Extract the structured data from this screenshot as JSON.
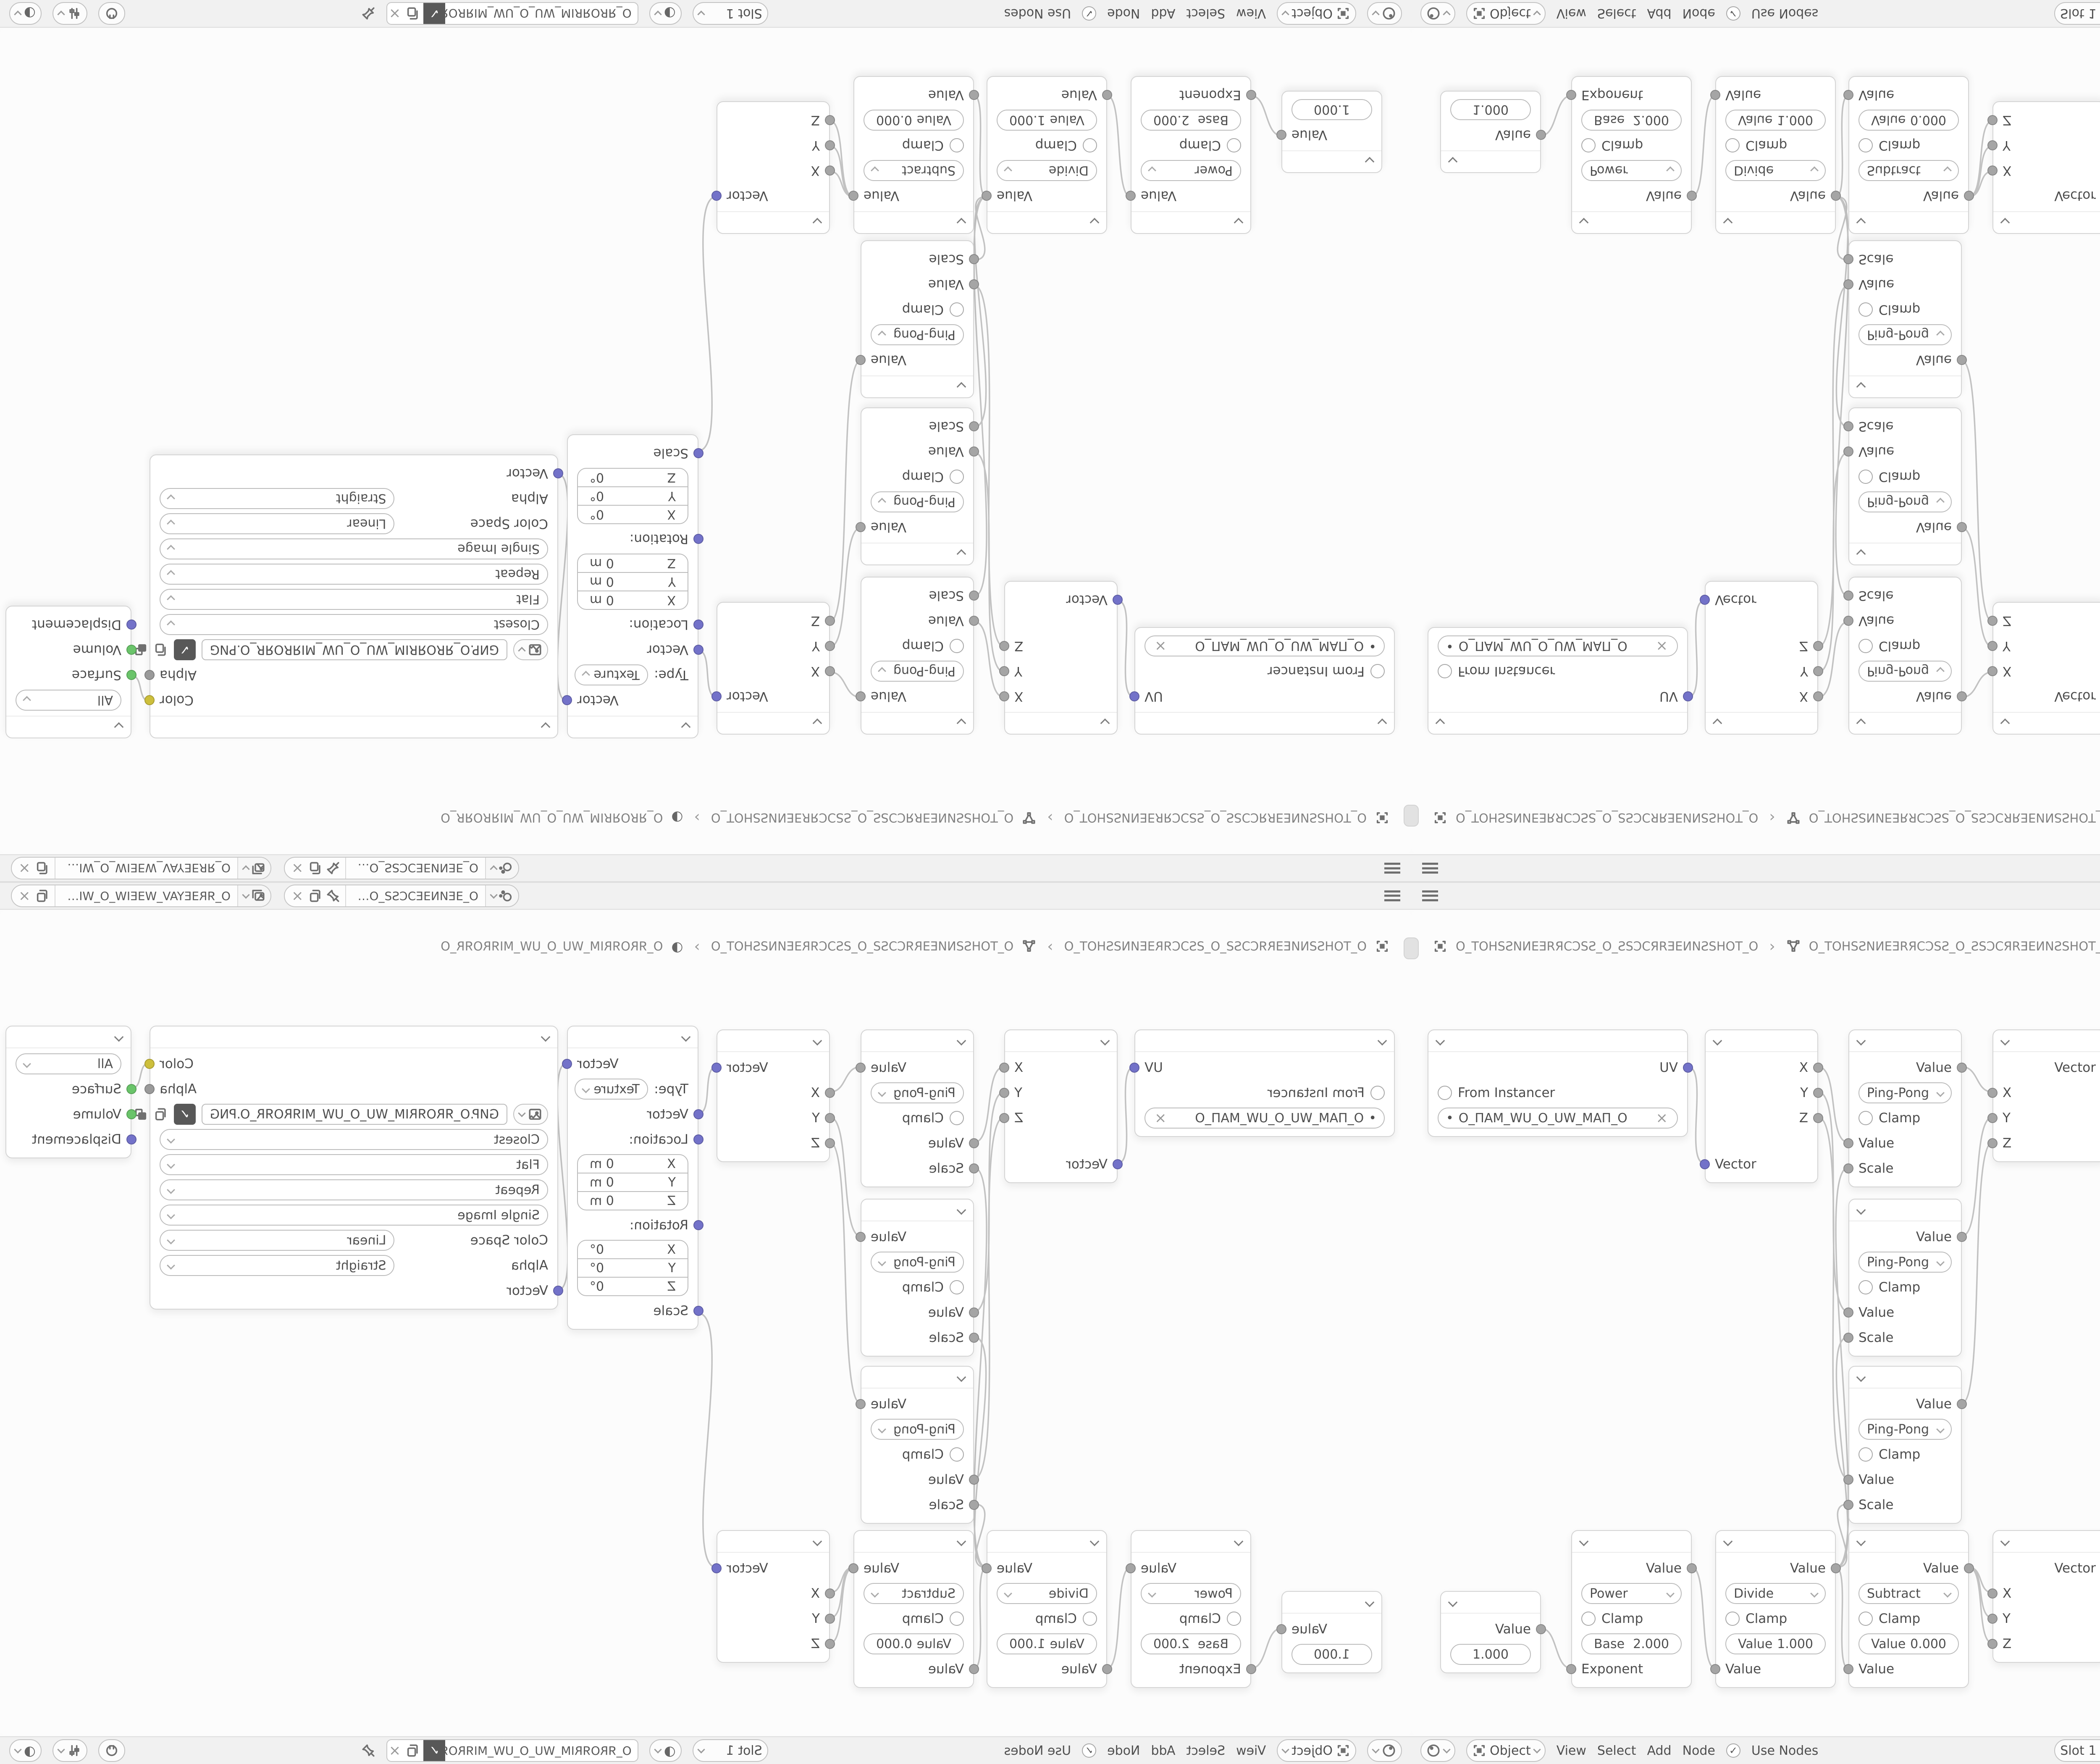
{
  "topbar": {
    "scene_name": "O_ƎEИNƎEƆCSƧ_O_ƧSƆCƎEИ...",
    "viewlayer_name": "O_ЯRƎEYAV_WƎEIW_O_WIƎEW_VAYƎERЯ_O"
  },
  "breadcrumb": {
    "separator": "›",
    "object_name": "O_TOHSƧNИEƎRЯCƆSƧ_O_ƧSƆCЯRƎEИNƧSHOT_O",
    "data_name": "O_TOHSƧNИEƎRЯCƆSƧ_O_ƧSƆCЯRƎEИNƧSHOT_O",
    "material_name": "O_ЯROЯRIM_WU_O_UW_MIЯROЯR_O"
  },
  "footer": {
    "mode": "Object",
    "menu_view": "View",
    "menu_select": "Select",
    "menu_add": "Add",
    "menu_node": "Node",
    "use_nodes": "Use Nodes",
    "check_mark": "✓",
    "slot": "Slot 1",
    "material_name": "O_ЯROЯRIM_WU_O_UW_MIЯROЯR_O"
  },
  "nodes": {
    "uv_map": {
      "output": "UV",
      "from_instancer": "From Instancer",
      "uv_name": "O_ПAM_WU_O_UW_MAП_O",
      "dot": "•"
    },
    "separate_xyz": {
      "out_x": "X",
      "out_y": "Y",
      "out_z": "Z",
      "input": "Vector"
    },
    "math_pingpong": {
      "output": "Value",
      "operation": "Ping-Pong",
      "clamp": "Clamp",
      "in_value": "Value",
      "in_scale": "Scale"
    },
    "combine_xyz": {
      "output": "Vector",
      "in_x": "X",
      "in_y": "Y",
      "in_z": "Z"
    },
    "mapping": {
      "output": "Vector",
      "type_label": "Type:",
      "type_value": "Texture",
      "in_vector": "Vector",
      "location_label": "Location:",
      "rotation_label": "Rotation:",
      "scale_label": "Scale",
      "loc": [
        {
          "axis": "X",
          "v": "0 m"
        },
        {
          "axis": "Y",
          "v": "0 m"
        },
        {
          "axis": "Z",
          "v": "0 m"
        }
      ],
      "rot": [
        {
          "axis": "X",
          "v": "0°"
        },
        {
          "axis": "Y",
          "v": "0°"
        },
        {
          "axis": "Z",
          "v": "0°"
        }
      ]
    },
    "image_texture": {
      "out_color": "Color",
      "out_alpha": "Alpha",
      "filename": "GИP.O_ЯROЯRIM_WU_O_UW_MIЯROЯR_O.PNG",
      "shield_check": "✓",
      "interpolation": "Closest",
      "projection": "Flat",
      "extension": "Repeat",
      "source": "Single Image",
      "color_space_label": "Color Space",
      "color_space": "Linear",
      "alpha_label": "Alpha",
      "alpha_mode": "Straight",
      "in_vector": "Vector"
    },
    "material_output": {
      "target": "All",
      "in_surface": "Surface",
      "in_volume": "Volume",
      "in_displacement": "Displacement"
    },
    "math_power": {
      "output": "Value",
      "operation": "Power",
      "clamp": "Clamp",
      "field_label": "Base",
      "field_value": "2.000",
      "input": "Exponent"
    },
    "math_divide": {
      "output": "Value",
      "operation": "Divide",
      "clamp": "Clamp",
      "field_label": "Value",
      "field_value": "1.000",
      "input": "Value"
    },
    "math_subtract": {
      "output": "Value",
      "operation": "Subtract",
      "clamp": "Clamp",
      "field_label": "Value",
      "field_value": "0.000",
      "input": "Value"
    },
    "value_node": {
      "output": "Value",
      "value": "1.000"
    }
  },
  "colors": {
    "vector_socket": "#7372c9",
    "value_socket": "#a5a5a5",
    "color_socket": "#cdbf3c",
    "alpha_socket": "#9a9a9a",
    "shader_socket": "#6ac46a",
    "wire": "#c2c2c2"
  }
}
